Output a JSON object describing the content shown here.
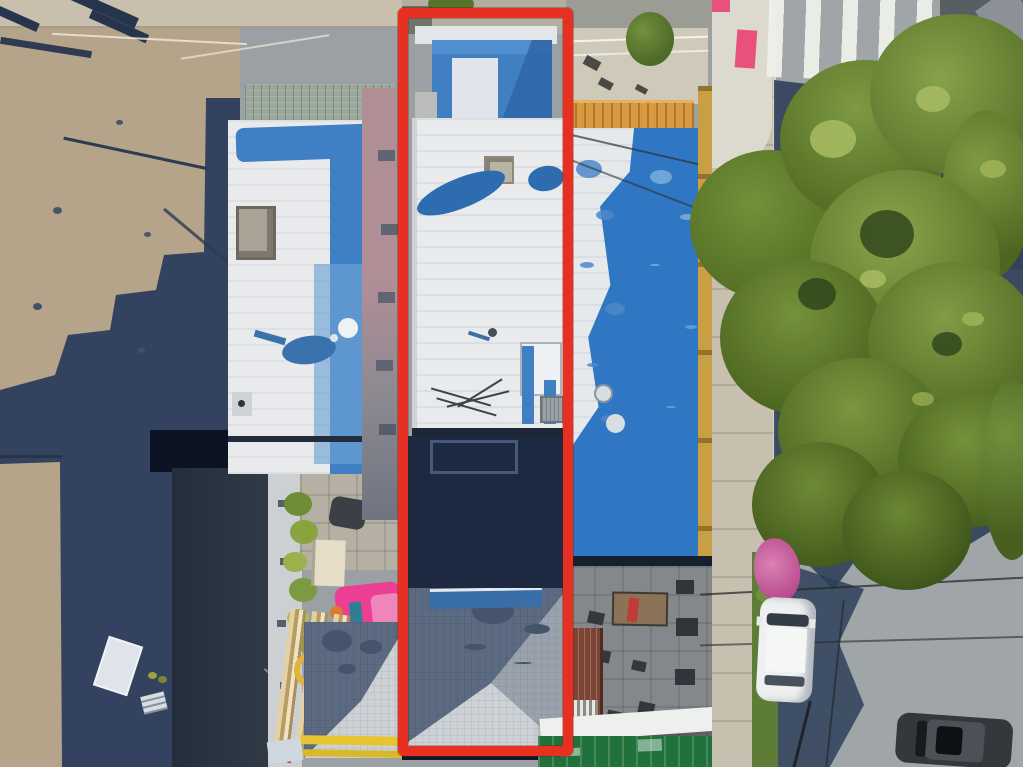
{
  "scene": {
    "title": "Aerial drone photograph of a city block with the subject property outlined in red",
    "annotation": {
      "label": "Subject property boundary highlight",
      "shape": "rectangle",
      "color": "#e63022"
    },
    "palette": {
      "lot_pavement": "#b5a489",
      "shadow_navy": "#2e4059",
      "roof_white": "#e8eaec",
      "roof_blue": "#2f77c2",
      "tree_green": "#6f8c3a",
      "street_asphalt": "#a0a5a8",
      "pergola_orange": "#d89a41",
      "awning_green": "#20713c",
      "pink_float": "#ec3f93",
      "crosswalk_white": "#eef0ea"
    },
    "objects": {
      "left_lot": "Paved schoolyard lot with fence lines and long building shadows",
      "left_building": "Neighboring building with white and blue flat roof, skylight hatch and satellite dish",
      "subject_property": "Subject lot: white flat-roof building, shaded rear yard and gray hip-roof rear structure",
      "right_building": "Neighboring building with blue painted roof, roof deck and orange pergola",
      "roof_deck_tree": "Round green tree on the roof deck",
      "backyard_patio": "Rear patio with tables, chairs and brown corrugated shed roof",
      "green_awning": "Green storefront awning along the sidewalk",
      "street": "Asphalt street shaded by a large tree canopy",
      "crosswalk": "White striped pedestrian crosswalk with pink curb markings",
      "street_tree": "Large green street tree canopy",
      "white_van": "White van parked near the corner",
      "white_suv": "White SUV parked along the curb",
      "white_car": "White car parked beneath the tree",
      "dark_car": "Dark sedan at the bottom right",
      "pink_blossom": "Pink flowering shrub beside the sidewalk",
      "pink_pool_float": "Pink inflatable in the neighboring backyard",
      "lumber_pile": "Stacked lumber boards in the neighboring yard"
    }
  }
}
